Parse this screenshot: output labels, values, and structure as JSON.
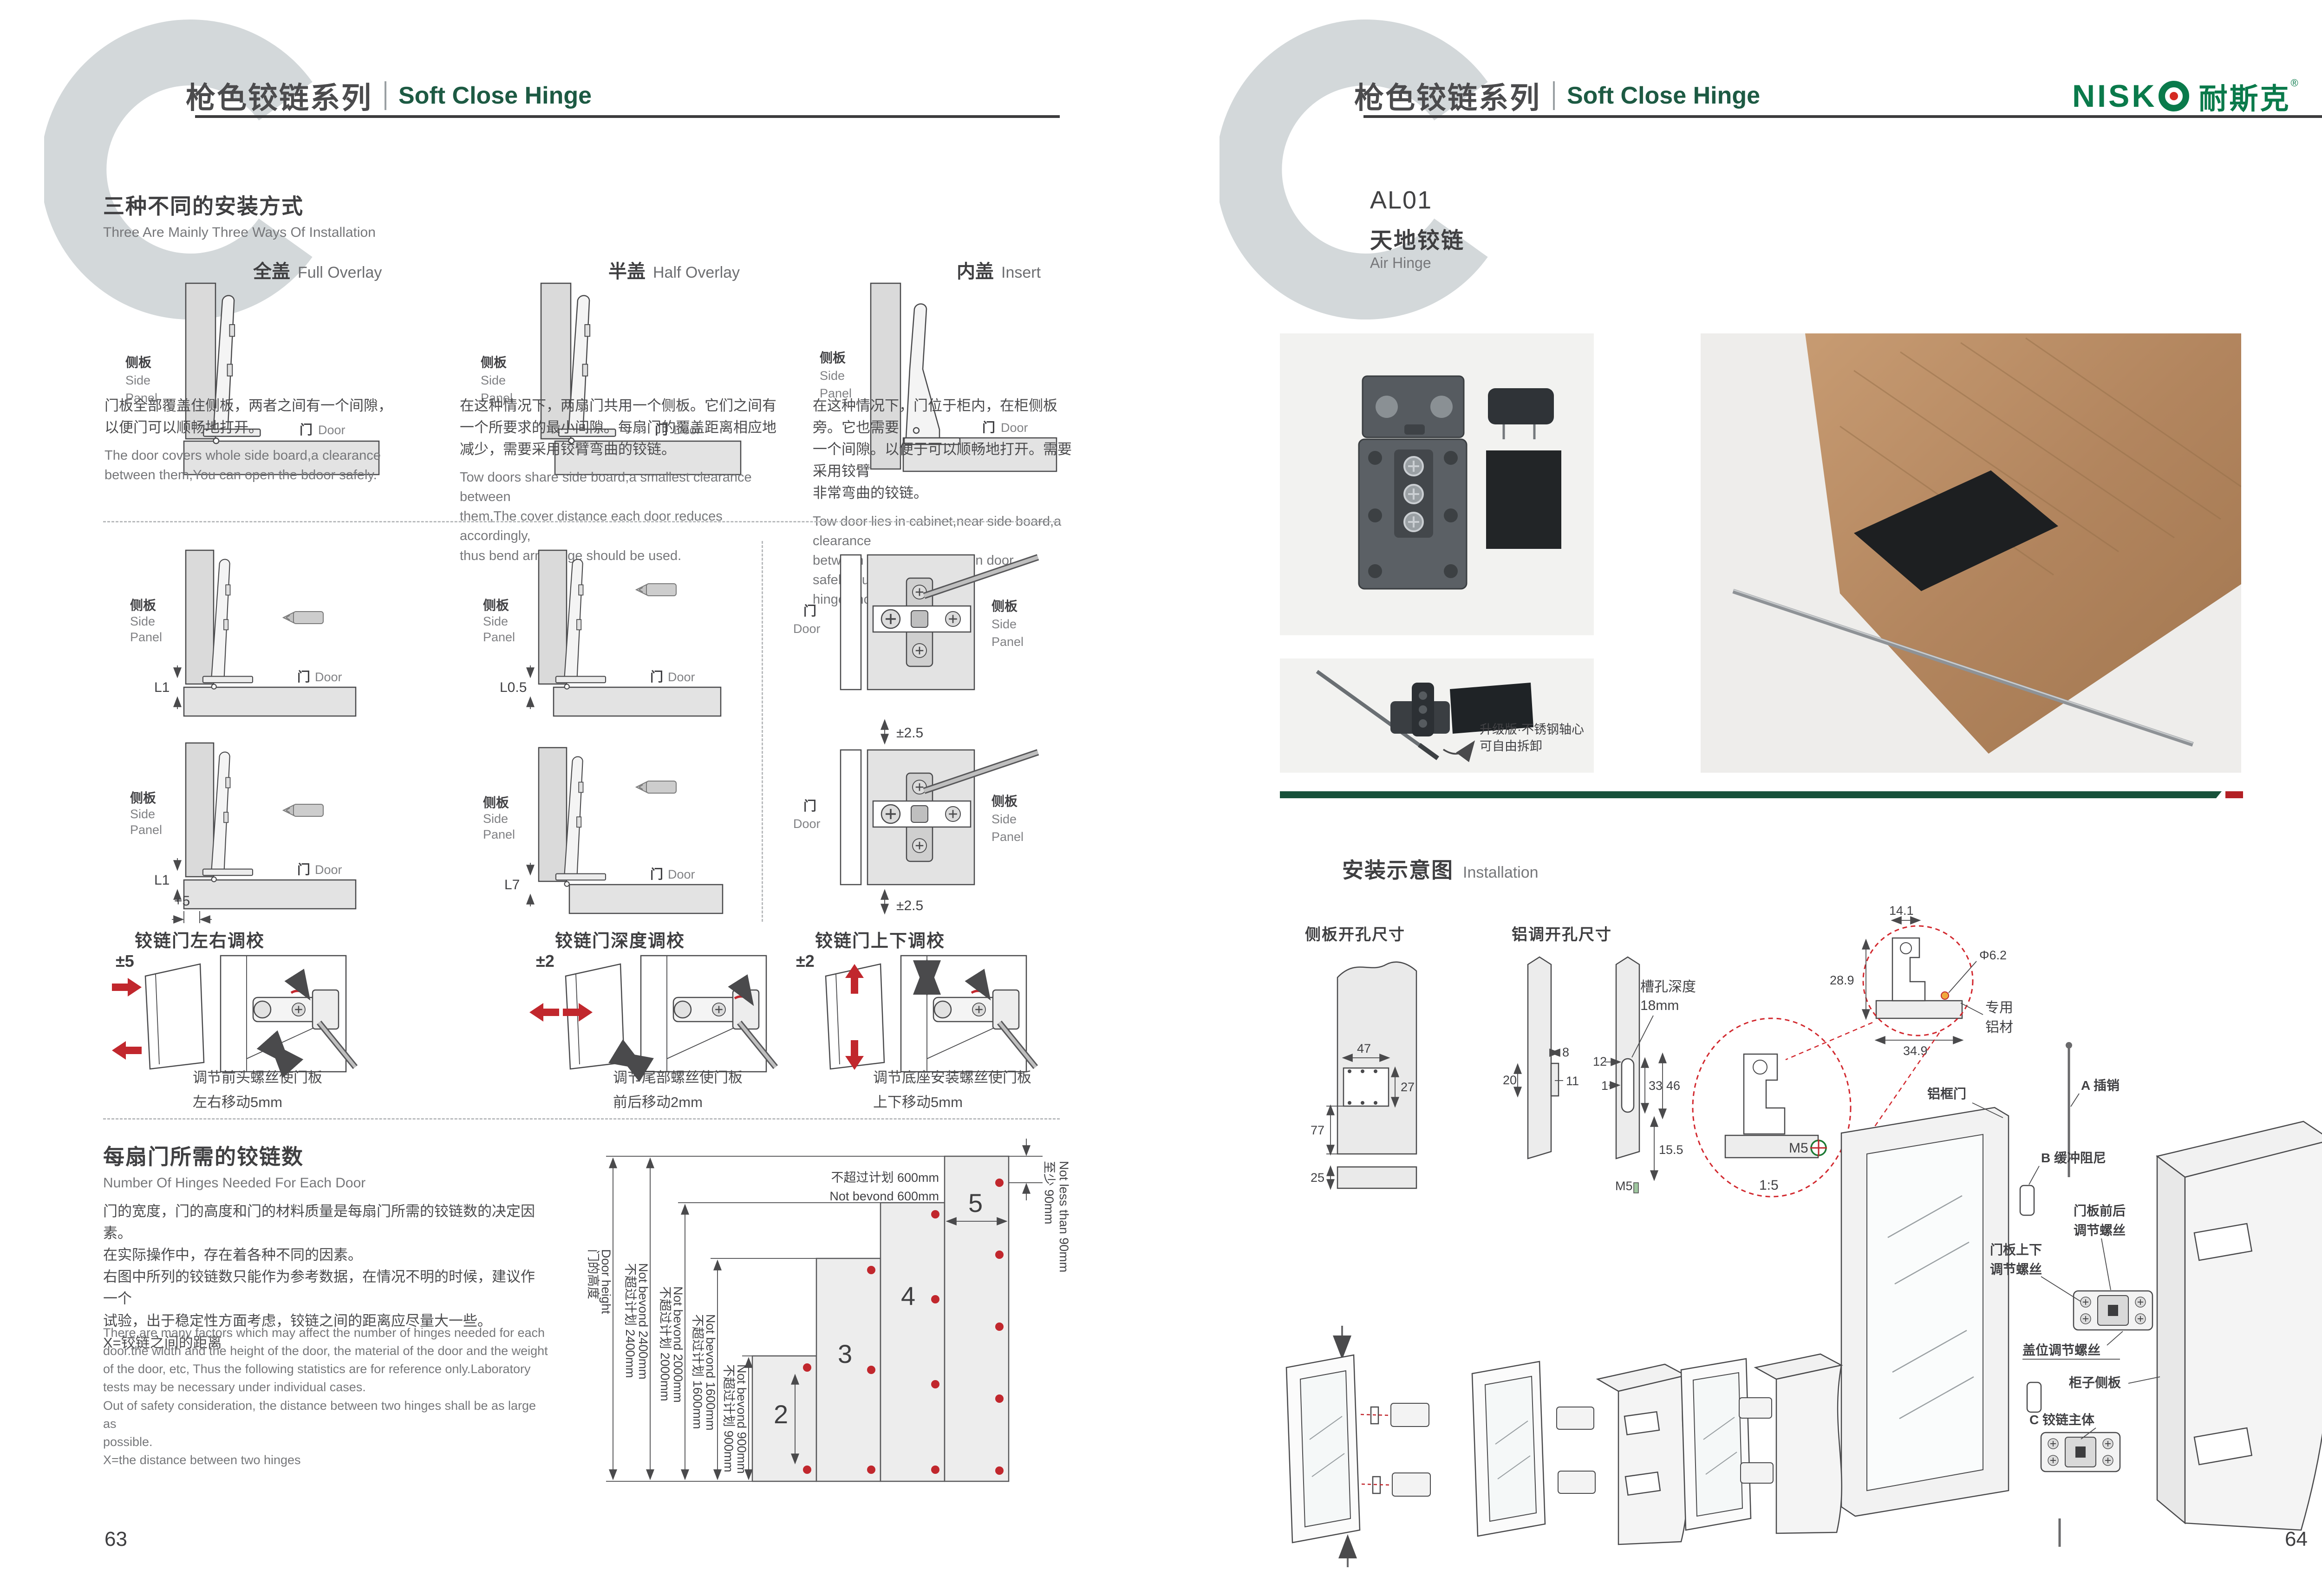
{
  "page": {
    "left_number": "63",
    "right_number": "64"
  },
  "header": {
    "series_cn": "枪色铰链系列",
    "series_en": "Soft Close Hinge",
    "logo_latin": "NISK",
    "logo_cn": "耐斯克",
    "logo_reg": "®"
  },
  "ways": {
    "title_cn": "三种不同的安装方式",
    "title_en": "Three Are Mainly Three Ways Of Installation",
    "labels": {
      "side_cn": "侧板",
      "side_en_1": "Side",
      "side_en_2": "Panel",
      "door_cn": "门",
      "door_en": "Door"
    },
    "methods": [
      {
        "name_cn": "全盖",
        "name_en": "Full Overlay",
        "desc_cn": "门板全部覆盖住侧板，两者之间有一个间隙，\n以便门可以顺畅地打开。",
        "desc_en": "The door covers whole side board,a clearance\nbetween them,You can open the bdoor safely."
      },
      {
        "name_cn": "半盖",
        "name_en": "Half Overlay",
        "desc_cn": "在这种情况下，两扇门共用一个侧板。它们之间有\n一个所要求的最小间隙。每扇门的覆盖距离相应地\n减少，需要采用铰臂弯曲的铰链。",
        "desc_en": "Tow doors share side board,a smallest clearance between\nthem,The cover distance each door reduces accordingly,\nthus bend arm hinge should be used."
      },
      {
        "name_cn": "内盖",
        "name_en": "Insert",
        "desc_cn": "在这种情况下，门位于柜内，在柜侧板旁。它也需要\n一个间隙。以便于可以顺畅地打开。需要采用铰臂\n非常弯曲的铰链。",
        "desc_en": "Tow door lies in cabinet,near side board,a clearance\nbetween them.You can open door safely,thus arm\nhinge should be used."
      }
    ],
    "dims": {
      "full": "L1",
      "half": "L0.5",
      "full2": "L1",
      "plus": "+5",
      "insert": "L7",
      "plate": "±2.5"
    }
  },
  "adjustments": [
    {
      "title": "铰链门左右调校",
      "range": "±5",
      "caption_1": "调节前头螺丝使门板",
      "caption_2": "左右移动5mm"
    },
    {
      "title": "铰链门深度调校",
      "range": "±2",
      "caption_1": "调节尾部螺丝使门板",
      "caption_2": "前后移动2mm"
    },
    {
      "title": "铰链门上下调校",
      "range": "±2",
      "caption_1": "调节底座安装螺丝使门板",
      "caption_2": "上下移动5mm"
    }
  ],
  "hinge_count": {
    "title_cn": "每扇门所需的铰链数",
    "title_en": "Number Of Hinges Needed For Each Door",
    "desc_cn_lines": [
      "门的宽度，门的高度和门的材料质量是每扇门所需的铰链数的决定因素。",
      "在实际操作中，存在着各种不同的因素。",
      "右图中所列的铰链数只能作为参考数据，在情况不明的时候，建议作一个",
      "试验，出于稳定性方面考虑，铰链之间的距离应尽量大一些。",
      "X=铰链之间的距离"
    ],
    "desc_en_lines": [
      "There are many factors which may affect the number of hinges needed for each",
      "door.the width and the height of the door, the material of the door and the weight",
      "of the door, etc, Thus the following statistics are for reference only.Laboratory",
      "tests may be necessary under individual cases.",
      "Out of safety consideration, the distance between two hinges shall be as large as",
      "possible.",
      "X=the distance between two hinges"
    ]
  },
  "chart_data": {
    "type": "bar",
    "title": "每扇门所需的铰链数 Number Of Hinges Needed For Each Door",
    "door_height_label_cn": "门的高度",
    "door_height_label_en": "Door height",
    "height_limits": [
      {
        "cn": "不超过计划 2400mm",
        "en": "Not bevond 2400mm",
        "mm": 2400
      },
      {
        "cn": "不超过计划 2000mm",
        "en": "Not bevond 2000mm",
        "mm": 2000
      },
      {
        "cn": "不超过计划 1600mm",
        "en": "Not bevond 1600mm",
        "mm": 1600
      },
      {
        "cn": "不超过计划 900mm",
        "en": "Not bevond 900mm",
        "mm": 900
      }
    ],
    "width_limit": {
      "cn": "不超过计划 600mm",
      "en": "Not bevond 600mm",
      "mm": 600
    },
    "top_margin": {
      "cn": "至少 90mm",
      "en": "Not less than 90mm",
      "mm": 90
    },
    "bars": [
      {
        "hinges": 2,
        "max_height_mm": 900
      },
      {
        "hinges": 3,
        "max_height_mm": 1600
      },
      {
        "hinges": 4,
        "max_height_mm": 2000
      },
      {
        "hinges": 5,
        "max_height_mm": 2400
      }
    ],
    "legend_position": "left",
    "grid": false
  },
  "product": {
    "code": "AL01",
    "name_cn": "天地铰链",
    "name_en": "Air Hinge",
    "note_1": "升级版·不锈钢轴心",
    "note_2": "可自由拆卸"
  },
  "install": {
    "title_cn": "安装示意图",
    "title_en": "Installation",
    "side_drill": {
      "title": "侧板开孔尺寸",
      "d47": "47",
      "d27": "27",
      "d77": "77",
      "d25": "25"
    },
    "alu_drill": {
      "title": "铝调开孔尺寸",
      "slot_1": "槽孔深度",
      "slot_2": "18mm",
      "d8": "8",
      "d20": "20",
      "d11": "11",
      "d12": "12",
      "d1": "1",
      "d33": "33",
      "d46": "46",
      "d155": "15.5",
      "m5": "M5"
    },
    "profile": {
      "d141": "14.1",
      "d289": "28.9",
      "dia": "Φ6.2",
      "d349": "34.9",
      "label_1": "专用",
      "label_2": "铝材",
      "m5": "M5",
      "scale": "1:5"
    },
    "exploded": {
      "alu_door": "铝框门",
      "a_pin": "A 插销",
      "b_damper": "B 缓冲阻尼",
      "fb_1": "门板前后",
      "fb_2": "调节螺丝",
      "ud_1": "门板上下",
      "ud_2": "调节螺丝",
      "overlay": "盖位调节螺丝",
      "cab_side": "柜子侧板",
      "c_hinge": "C 铰链主体"
    }
  }
}
